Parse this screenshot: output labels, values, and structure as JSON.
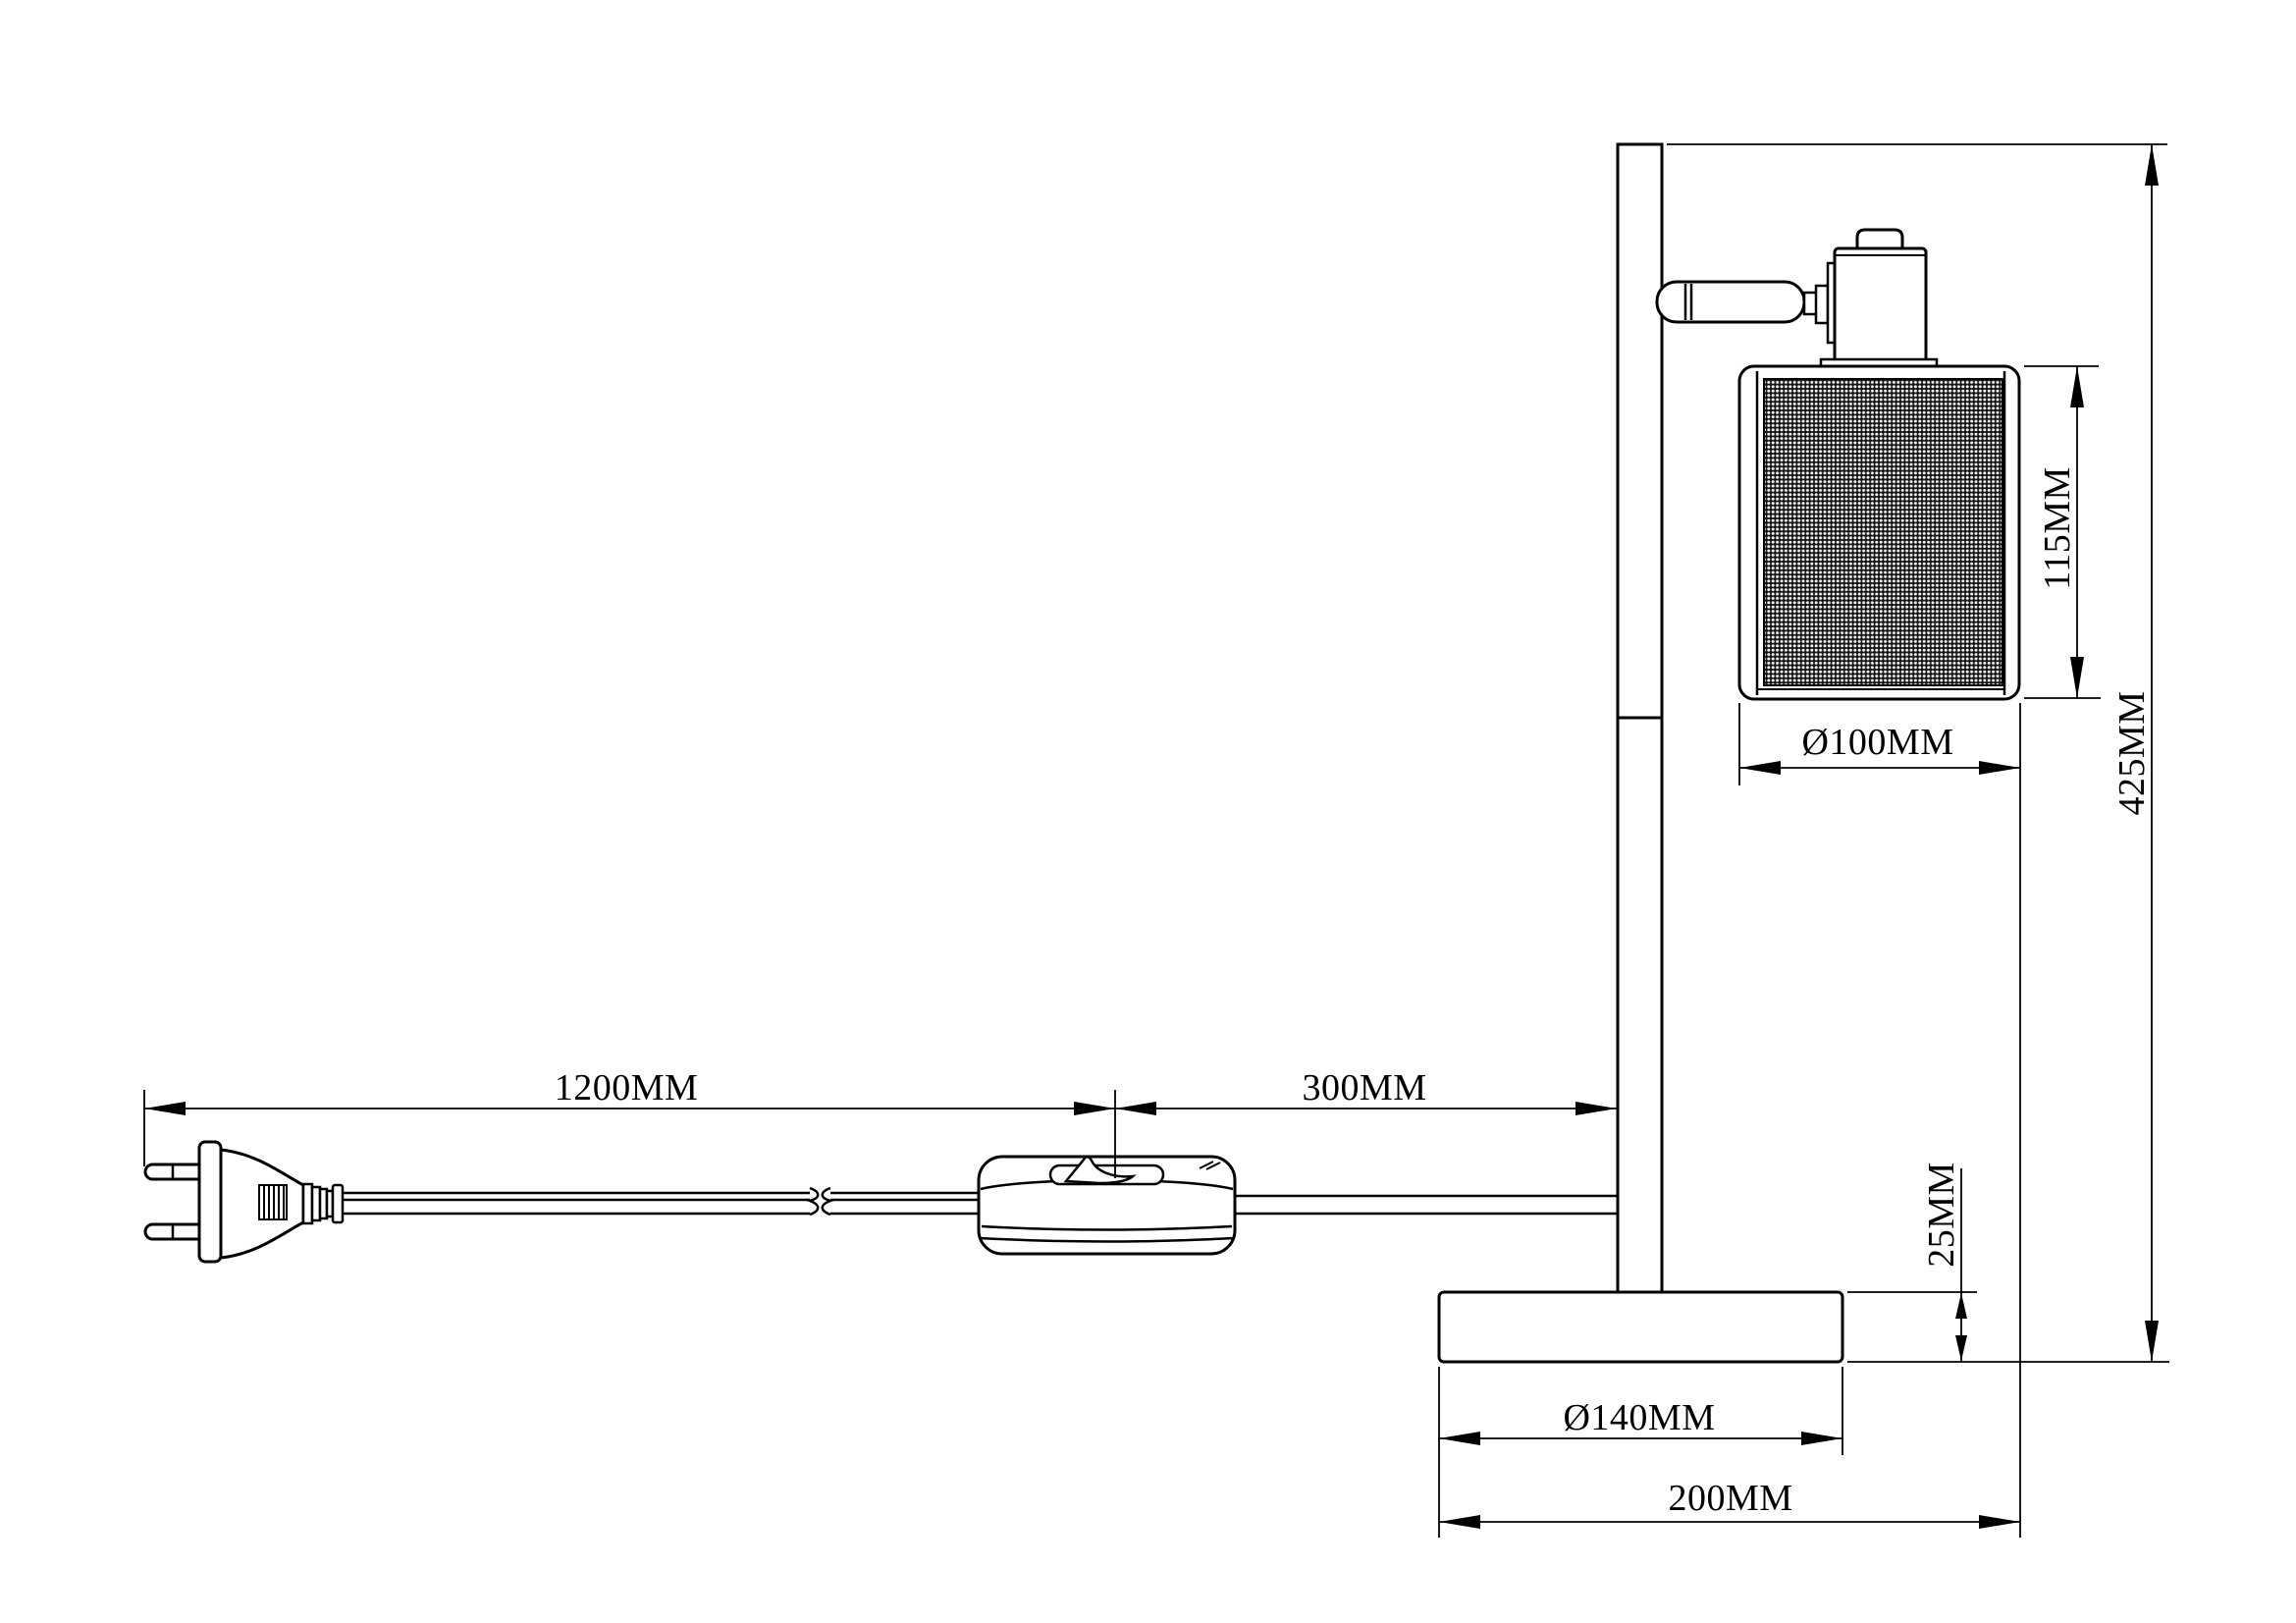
{
  "colors": {
    "background": "#ffffff",
    "line": "#000000",
    "mesh_fill": "#141414",
    "mesh_dot": "#f5f5f5"
  },
  "dims": {
    "cord_length": "1200MM",
    "switch_to_lamp": "300MM",
    "overall_height": "425MM",
    "shade_height": "115MM",
    "shade_diameter": "Ø100MM",
    "base_thickness": "25MM",
    "base_diameter": "Ø140MM",
    "overall_depth": "200MM"
  }
}
